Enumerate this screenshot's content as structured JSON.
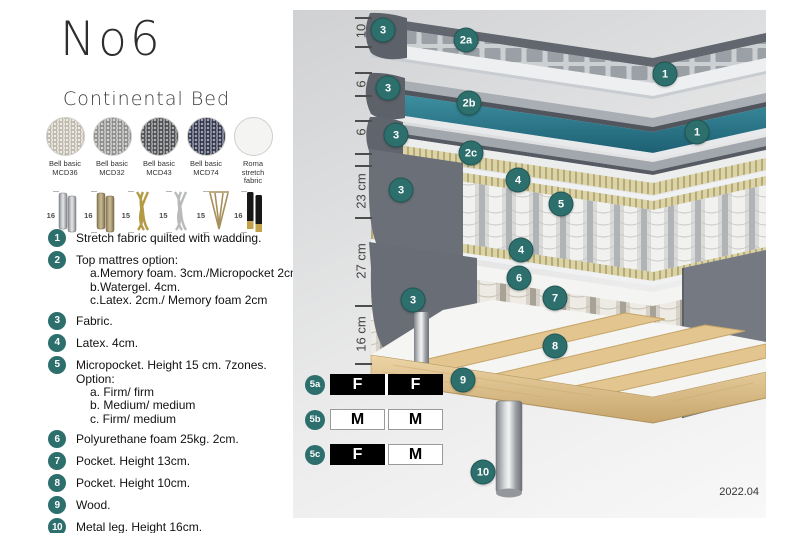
{
  "header": {
    "title": "No6",
    "subtitle": "Continental Bed"
  },
  "fabric_swatches": [
    {
      "name": "Bell basic",
      "code": "MCD36",
      "color": "#ded8ca"
    },
    {
      "name": "Bell basic",
      "code": "MCD32",
      "color": "#a3a3a1"
    },
    {
      "name": "Bell basic",
      "code": "MCD43",
      "color": "#54575a"
    },
    {
      "name": "Bell basic",
      "code": "MCD74",
      "color": "#343a55"
    },
    {
      "name": "Roma",
      "code": "stretch fabric",
      "color": "#f4f4f2"
    }
  ],
  "leg_options": [
    {
      "height": "16",
      "type": "cylinder-silver"
    },
    {
      "height": "16",
      "type": "cylinder-bronze"
    },
    {
      "height": "15",
      "type": "twisted-gold"
    },
    {
      "height": "15",
      "type": "twisted-silver"
    },
    {
      "height": "15",
      "type": "hairpin-brass"
    },
    {
      "height": "16",
      "type": "black-brass-tip"
    }
  ],
  "spec_list": [
    {
      "num": "1",
      "text": "Stretch fabric quilted with wadding."
    },
    {
      "num": "2",
      "text": "Top mattres option:",
      "subs": [
        "a.Memory foam. 3cm./Micropocket 2cm",
        "b.Watergel. 4cm.",
        "c.Latex. 2cm./ Memory foam 2cm"
      ]
    },
    {
      "num": "3",
      "text": "Fabric."
    },
    {
      "num": "4",
      "text": "Latex. 4cm."
    },
    {
      "num": "5",
      "text": "Micropocket. Height 15 cm. 7zones. Option:",
      "subs": [
        "a. Firm/ firm",
        "b. Medium/ medium",
        "c. Firm/ medium"
      ]
    },
    {
      "num": "6",
      "text": "Polyurethane foam 25kg. 2cm."
    },
    {
      "num": "7",
      "text": "Pocket. Height 13cm."
    },
    {
      "num": "8",
      "text": "Pocket. Height 10cm."
    },
    {
      "num": "9",
      "text": "Wood."
    },
    {
      "num": "10",
      "text": "Metal leg. Height 16cm."
    }
  ],
  "diagram": {
    "ruler_labels": [
      "10",
      "6",
      "6",
      "23 cm",
      "27 cm",
      "16 cm"
    ],
    "callouts": [
      {
        "label": "3"
      },
      {
        "label": "2a"
      },
      {
        "label": "1"
      },
      {
        "label": "3"
      },
      {
        "label": "2b"
      },
      {
        "label": "1"
      },
      {
        "label": "3"
      },
      {
        "label": "2c"
      },
      {
        "label": "4"
      },
      {
        "label": "5"
      },
      {
        "label": "3"
      },
      {
        "label": "4"
      },
      {
        "label": "6"
      },
      {
        "label": "7"
      },
      {
        "label": "3"
      },
      {
        "label": "8"
      },
      {
        "label": "9"
      },
      {
        "label": "10"
      }
    ],
    "firmness_table": [
      {
        "label": "5a",
        "cells": [
          {
            "text": "F",
            "tone": "dark"
          },
          {
            "text": "F",
            "tone": "dark"
          }
        ]
      },
      {
        "label": "5b",
        "cells": [
          {
            "text": "M",
            "tone": "light"
          },
          {
            "text": "M",
            "tone": "light"
          }
        ]
      },
      {
        "label": "5c",
        "cells": [
          {
            "text": "F",
            "tone": "dark"
          },
          {
            "text": "M",
            "tone": "light"
          }
        ]
      }
    ],
    "version": "2022.04"
  },
  "colors": {
    "accent_teal": "#2d6f6d",
    "watergel_teal": "#2a7e92",
    "latex_khaki": "#d9d0a2",
    "wood": "#dfc08f",
    "fabric_gray": "#6b7078"
  }
}
